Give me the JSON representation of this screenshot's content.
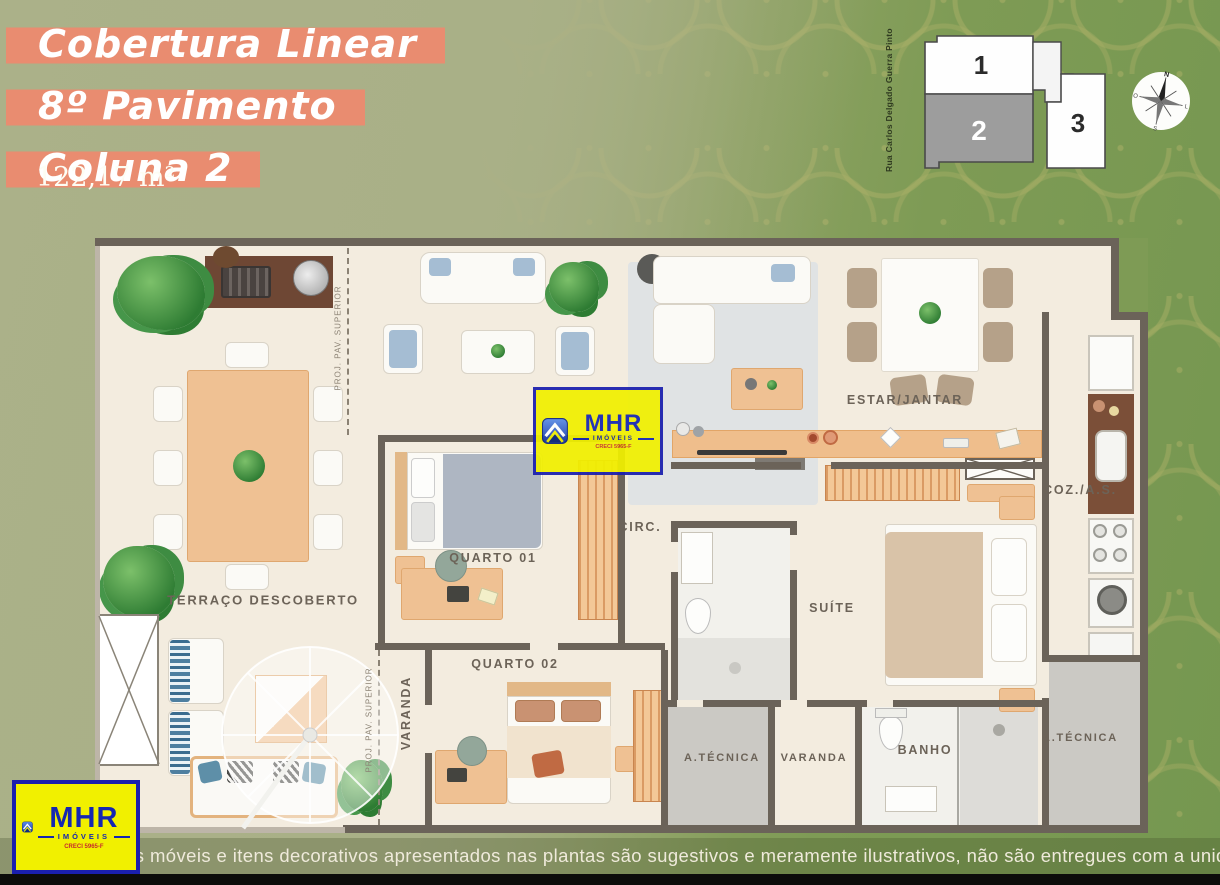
{
  "header": {
    "accent_color": "#E98C70",
    "title_lines": [
      "Cobertura Linear",
      "8º Pavimento",
      "Coluna 2"
    ],
    "area": "122,17 m²"
  },
  "key_plan": {
    "street": "Rua Carlos Delgado Guerra Pinto",
    "unit1": "1",
    "unit2": "2",
    "unit3": "3",
    "highlight_color": "#9D9D9D"
  },
  "compass": {
    "n": "N",
    "e": "L",
    "s": "S",
    "w": "O"
  },
  "floor_plan": {
    "labels": {
      "terraco": "TERRAÇO DESCOBERTO",
      "quarto01": "QUARTO 01",
      "quarto02": "QUARTO 02",
      "varanda_left": "VARANDA",
      "circ": "CIRC.",
      "estar_jantar": "ESTAR/JANTAR",
      "coz_as": "COZ./A.S.",
      "suite": "SUÍTE",
      "atecnica_left": "A.TÉCNICA",
      "varanda_bottom": "VARANDA",
      "banho": "BANHO",
      "atecnica_right": "A.TÉCNICA",
      "proj_pav_superior": "PROJ. PAV. SUPERIOR"
    }
  },
  "watermark": {
    "brand": "MHR",
    "subtitle": "IMÓVEIS",
    "creci": "CRECI 5965-F"
  },
  "footer": {
    "disclaimer": "Os móveis e itens decorativos apresentados nas plantas são sugestivos e meramente ilustrativos, não são entregues com a unidade."
  }
}
